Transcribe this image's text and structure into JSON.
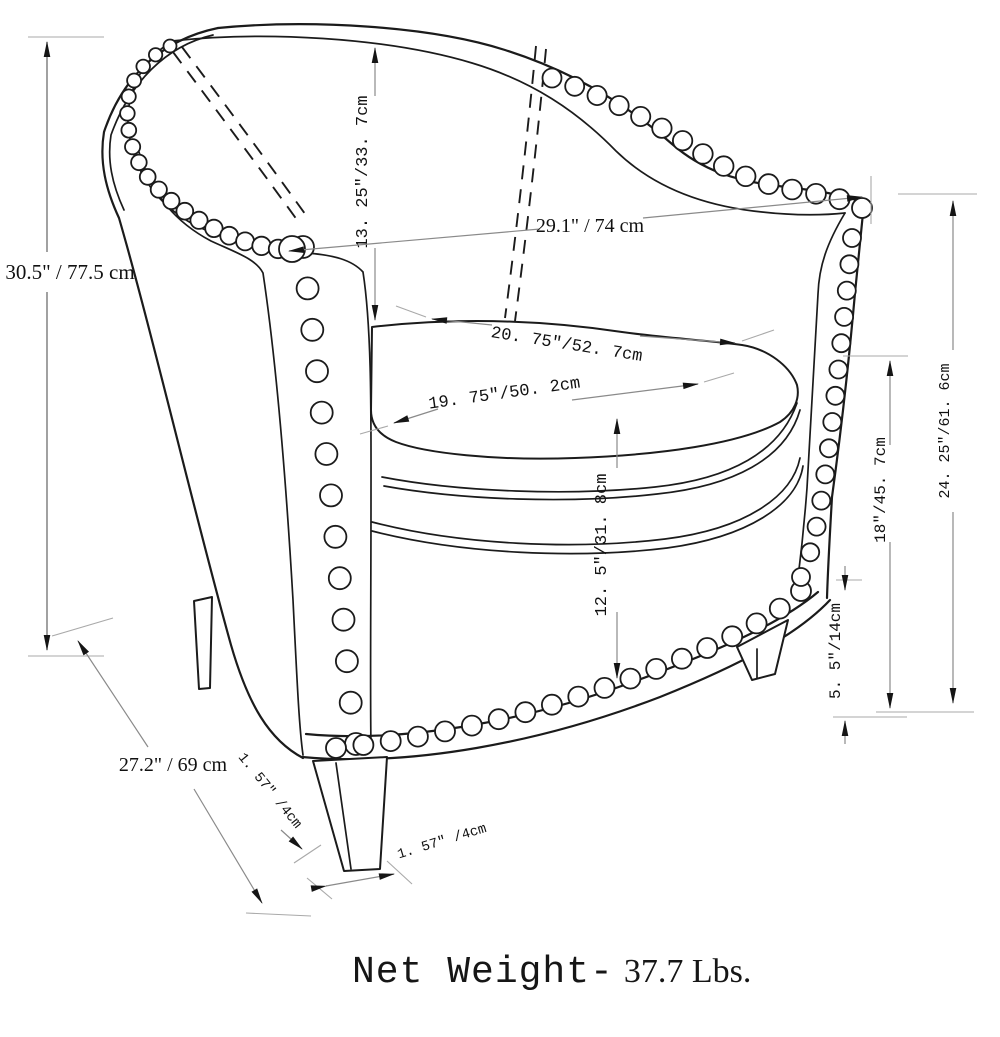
{
  "title": "Tub accent chair dimension diagram",
  "dims": {
    "overall_height": "30.5\" / 77.5 cm",
    "back_cushion_height": "13. 25″/33. 7cm",
    "overall_width": "29.1\" / 74 cm",
    "seat_depth": "20. 75″/52. 7cm",
    "seat_width": "19. 75″/50. 2cm",
    "seat_front_height": "12. 5″/31. 8cm",
    "arm_height": "24. 25″/61. 6cm",
    "back_height_from_floor": "18″/45. 7cm",
    "leg_height": "5. 5″/14cm",
    "overall_depth": "27.2\" / 69 cm",
    "leg_width_front": "1. 57″ /4cm",
    "leg_width_side": "1. 57″ /4cm"
  },
  "footer": {
    "net_weight_label": "Net Weight-",
    "net_weight_value": "37.7 Lbs."
  },
  "colors": {
    "line": "#1b1b1b",
    "dimension_line": "#8a8a8a",
    "background": "#ffffff"
  }
}
